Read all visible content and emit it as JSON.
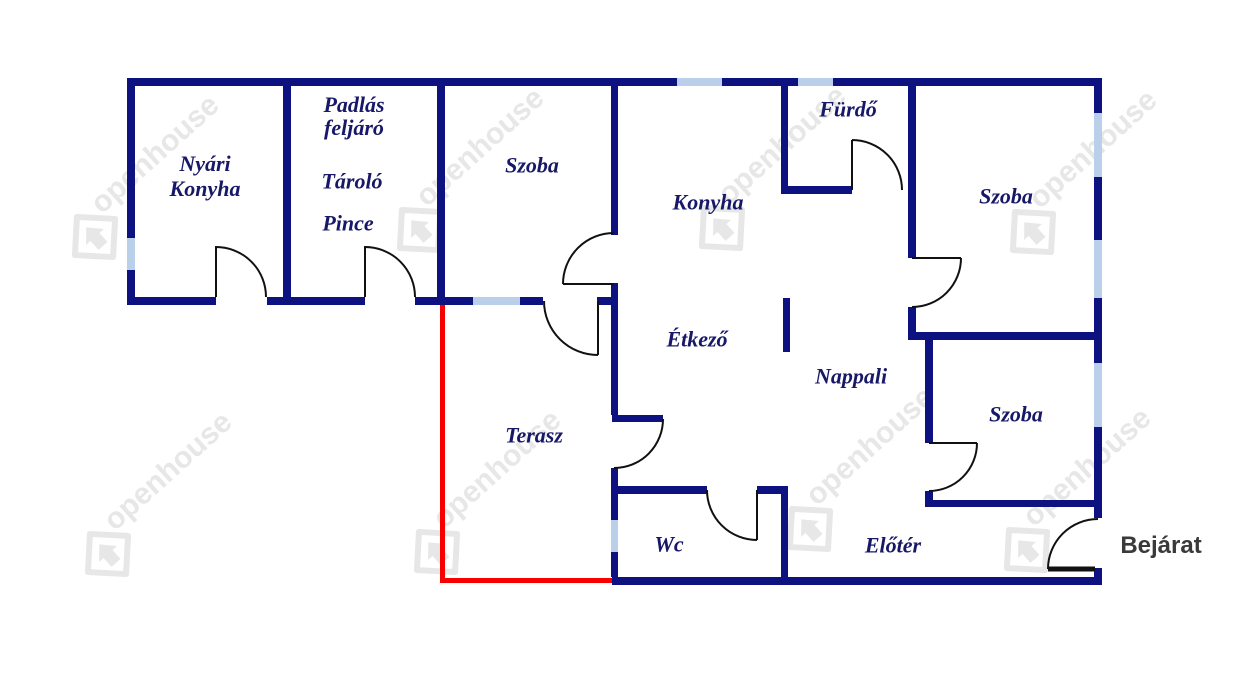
{
  "colors": {
    "wall": "#0d1280",
    "window": "#b9cfea",
    "door": "#111111",
    "terrace": "#f80000",
    "label": "#181868",
    "entrance": "#3a3a3a",
    "watermark": "#e7e7e7"
  },
  "labels": {
    "nyari_konyha": {
      "line1": "Nyári",
      "line2": "Konyha"
    },
    "padlas_feljaro": {
      "line1": "Padlás",
      "line2": "feljáró"
    },
    "tarolo": "Tároló",
    "pince": "Pince",
    "szoba_top": "Szoba",
    "konyha": "Konyha",
    "furdo": "Fürdő",
    "szoba_right_top": "Szoba",
    "etkezo": "Étkező",
    "nappali": "Nappali",
    "terasz": "Terasz",
    "szoba_right_bottom": "Szoba",
    "wc": "Wc",
    "eloter": "Előtér",
    "bejarat": "Bejárat"
  },
  "watermark": {
    "text": "openhouse"
  }
}
